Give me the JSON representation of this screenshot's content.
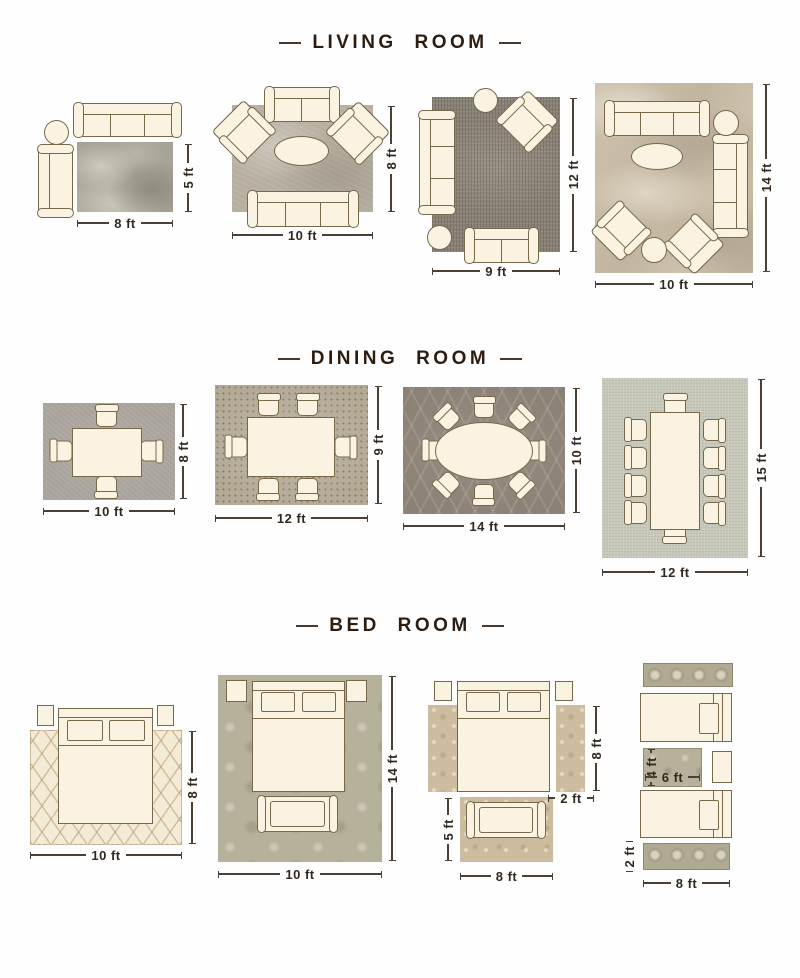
{
  "sections": {
    "living": {
      "title": "LIVING ROOM",
      "layouts": [
        {
          "rug_w": "8 ft",
          "rug_h": "5 ft"
        },
        {
          "rug_w": "10 ft",
          "rug_h": "8 ft"
        },
        {
          "rug_w": "9 ft",
          "rug_h": "12 ft"
        },
        {
          "rug_w": "10 ft",
          "rug_h": "14 ft"
        }
      ]
    },
    "dining": {
      "title": "DINING ROOM",
      "layouts": [
        {
          "rug_w": "10 ft",
          "rug_h": "8 ft"
        },
        {
          "rug_w": "12 ft",
          "rug_h": "9 ft"
        },
        {
          "rug_w": "14 ft",
          "rug_h": "10 ft"
        },
        {
          "rug_w": "12 ft",
          "rug_h": "15 ft"
        }
      ]
    },
    "bed": {
      "title": "BED ROOM",
      "layouts": [
        {
          "rug_w": "10 ft",
          "rug_h": "8 ft"
        },
        {
          "rug_w": "10 ft",
          "rug_h": "14 ft"
        },
        {
          "runner_h": "8 ft",
          "runner_w": "2 ft",
          "front_rug_h": "5 ft",
          "front_rug_w": "8 ft"
        },
        {
          "mid_rug_h": "4 ft",
          "mid_rug_w": "6 ft",
          "runner_h": "2 ft",
          "runner_w": "8 ft"
        }
      ]
    }
  },
  "colors": {
    "heading_text": "#2e1d0f",
    "dimension_text": "#32291e",
    "furniture_fill": "#faf3e2",
    "furniture_outline": "#77684a",
    "rug_grey_abstract": "#a7a397",
    "rug_taupe": "#b6afa0",
    "rug_dark_vintage": "#8a8277",
    "rug_beige_marble": "#c6b9a4",
    "rug_grey_plain": "#a7a29a",
    "rug_mosaic": "#b3a995",
    "rug_trellis_dark": "#8c8176",
    "rug_sage_plain": "#c6c7b9",
    "rug_cream_lattice": "#f4ebd6",
    "rug_damask_sage": "#b5b19b",
    "rug_tan_floral": "#ccbb9e",
    "rug_medallion": "#b1aa93"
  }
}
